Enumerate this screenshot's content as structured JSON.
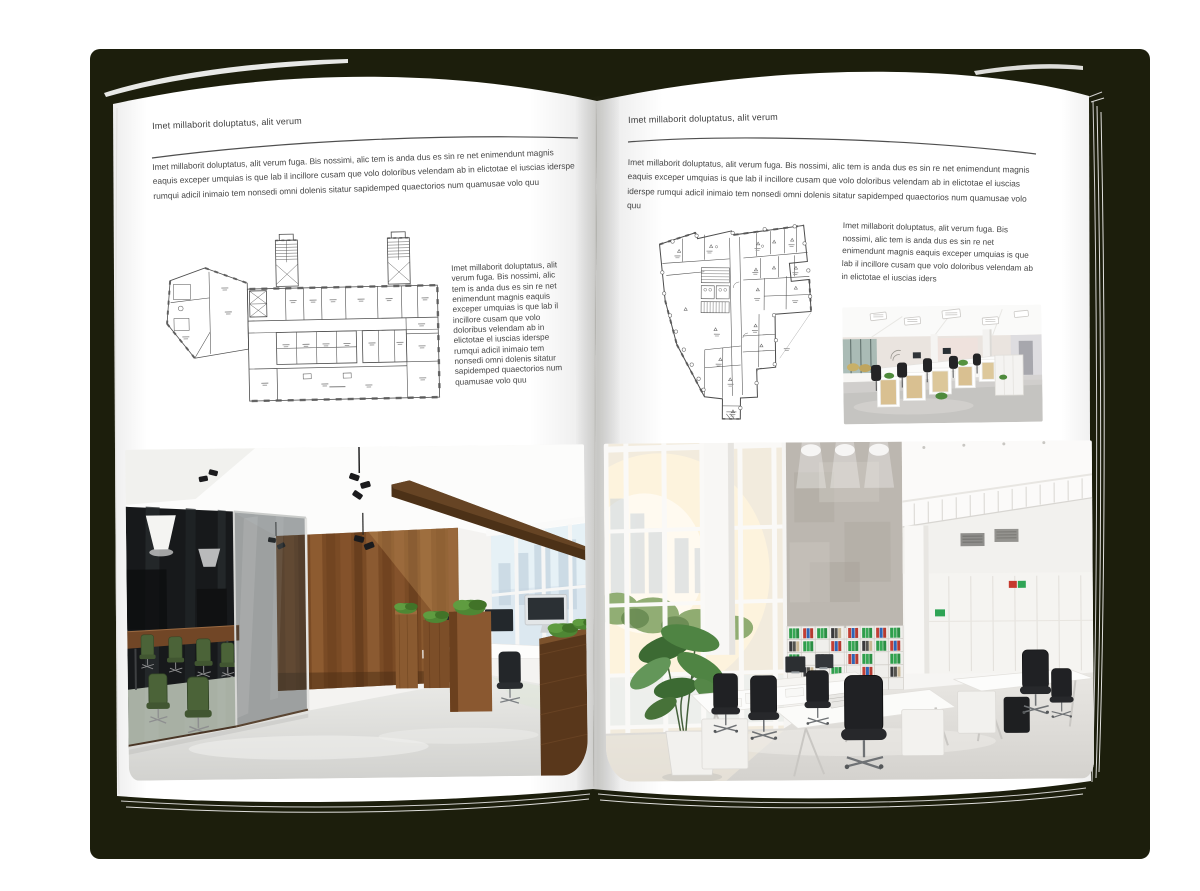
{
  "spread": {
    "left_page": {
      "header": "Imet millaborit doluptatus, alit verum",
      "intro": "Imet millaborit doluptatus, alit verum fuga. Bis nossimi, alic tem is anda dus es sin re net enimendunt magnis eaquis exceper umquias is que lab il incillore cusam que volo doloribus velendam ab in elictotae el iuscias iderspe rumqui adicil inimaio tem nonsedi omni dolenis sitatur sapidemped quaectorios num quamusae volo quu",
      "caption": "Imet millaborit doluptatus, alit verum fuga. Bis nossimi, alic tem is anda dus es sin re net enimendunt magnis eaquis exceper umquias is que lab il incillore cusam que volo doloribus velendam ab in elictotae el iuscias iderspe rumqui adicil inimaio tem nonsedi omni dolenis sitatur sapidemped quaectorios num quamusae volo quu"
    },
    "right_page": {
      "header": "Imet millaborit doluptatus, alit verum",
      "intro": "Imet millaborit doluptatus, alit verum fuga. Bis nossimi, alic tem is anda dus es sin re net enimendunt magnis eaquis exceper umquias is que lab il incillore cusam que volo doloribus velendam ab in elictotae el iuscias iderspe rumqui adicil inimaio tem nonsedi omni dolenis sitatur sapidemped quaectorios num quamusae volo quu",
      "caption": "Imet millaborit doluptatus, alit verum fuga. Bis nossimi, alic tem is anda dus es sin re net enimendunt magnis eaquis exceper umquias is que lab il incillore cusam que volo doloribus velendam ab in elictotae el iuscias iders"
    },
    "colors": {
      "cover": "#1c1e0c",
      "page": "#ffffff",
      "text": "#474747",
      "rule": "#4f4f4f",
      "plan_line": "#4d4d4d"
    }
  }
}
